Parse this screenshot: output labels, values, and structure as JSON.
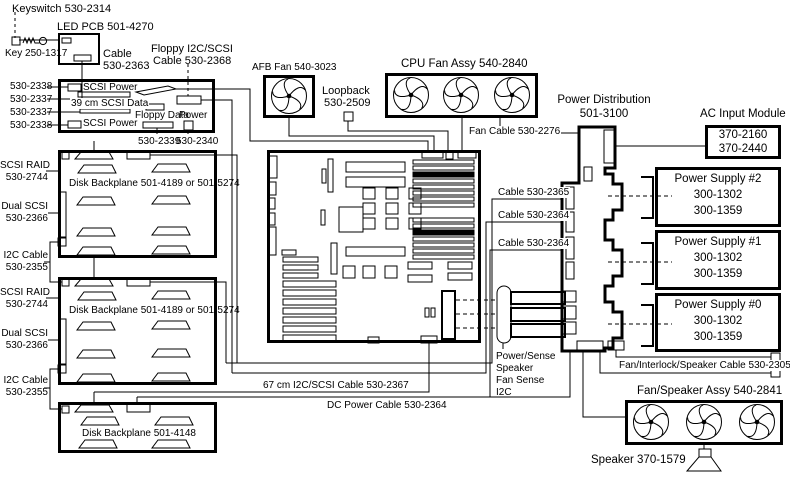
{
  "keyswitch_label": "Keyswitch 530-2314",
  "key_label": "Key 250-1317",
  "led_pcb_label": "LED PCB 501-4270",
  "cable_2363": [
    "Cable",
    "530-2363"
  ],
  "floppy_cable": [
    "Floppy I2C/SCSI",
    "Cable 530-2368"
  ],
  "io_board": {
    "left_pns": [
      "530-2338",
      "530-2337",
      "530-2337",
      "530-2338"
    ],
    "scsi_power_top": "SCSI Power",
    "scsi_data": "39 cm SCSI Data",
    "scsi_power_bottom": "SCSI Power",
    "floppy_data": "Floppy Data",
    "power": "Power",
    "floppy_pn": "530-2339",
    "power_pn": "530-2340"
  },
  "afb_fan_label": "AFB Fan 540-3023",
  "loopback": [
    "Loopback",
    "530-2509"
  ],
  "cpu_fan_label": "CPU Fan Assy 540-2840",
  "fan_cable_label": "Fan Cable 530-2276",
  "power_distribution": [
    "Power Distribution",
    "501-3100"
  ],
  "ac_input": {
    "title": "AC Input Module",
    "pns": [
      "370-2160",
      "370-2440"
    ]
  },
  "power_supplies": [
    {
      "title": "Power Supply #2",
      "pns": [
        "300-1302",
        "300-1359"
      ]
    },
    {
      "title": "Power Supply #1",
      "pns": [
        "300-1302",
        "300-1359"
      ]
    },
    {
      "title": "Power Supply #0",
      "pns": [
        "300-1302",
        "300-1359"
      ]
    }
  ],
  "backplane1": {
    "scsi_raid": [
      "SCSI RAID",
      "530-2744"
    ],
    "dual_scsi": [
      "Dual SCSI",
      "530-2366"
    ],
    "i2c": [
      "I2C Cable",
      "530-2355"
    ],
    "name": "Disk Backplane 501-4189 or 501-5274"
  },
  "backplane2": {
    "scsi_raid": [
      "SCSI RAID",
      "530-2744"
    ],
    "dual_scsi": [
      "Dual SCSI",
      "530-2366"
    ],
    "i2c": [
      "I2C Cable",
      "530-2355"
    ],
    "name": "Disk Backplane 501-4189 or 501-5274"
  },
  "backplane3": {
    "name": "Disk Backplane 501-4148"
  },
  "cables": {
    "c2365": "Cable 530-2365",
    "c2364_a": "Cable 530-2364",
    "c2364_b": "Cable 530-2364",
    "i2c_scsi_67": "67 cm I2C/SCSI Cable 530-2367",
    "dc_power": "DC Power Cable 530-2364",
    "power_sense": [
      "Power/Sense",
      "Speaker",
      "Fan Sense",
      "I2C"
    ],
    "fan_interlock": "Fan/Interlock/Speaker Cable 530-2305"
  },
  "fan_speaker_label": "Fan/Speaker Assy 540-2841",
  "speaker_label": "Speaker 370-1579"
}
